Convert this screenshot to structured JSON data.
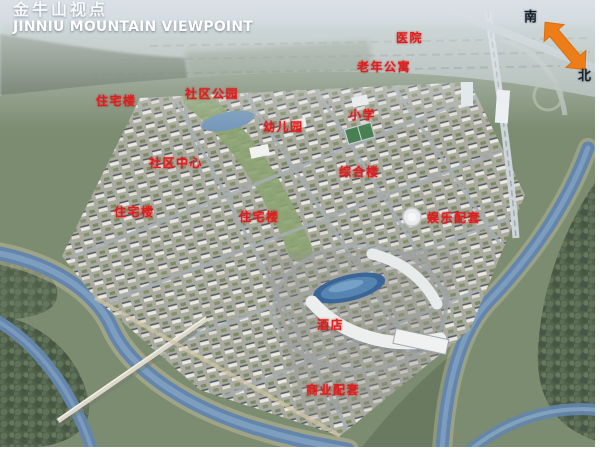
{
  "header": {
    "title_zh": "金牛山视点",
    "title_en": "JINNIU MOUNTAIN VIEWPOINT"
  },
  "compass": {
    "south_label": "南",
    "north_label": "北",
    "arrow_icon": "double-headed-arrow",
    "arrow_color": "#ed7d18"
  },
  "map_labels": [
    {
      "id": "hospital",
      "text": "医院",
      "x": 396,
      "y": 32
    },
    {
      "id": "elderly-apartments",
      "text": "老年公寓",
      "x": 357,
      "y": 61
    },
    {
      "id": "community-park",
      "text": "社区公园",
      "x": 185,
      "y": 88
    },
    {
      "id": "residential-upper-left",
      "text": "住宅楼",
      "x": 96,
      "y": 95
    },
    {
      "id": "primary-school",
      "text": "小学",
      "x": 349,
      "y": 109
    },
    {
      "id": "kindergarten",
      "text": "幼儿园",
      "x": 263,
      "y": 121
    },
    {
      "id": "community-center",
      "text": "社区中心",
      "x": 149,
      "y": 157
    },
    {
      "id": "complex-building",
      "text": "综合楼",
      "x": 339,
      "y": 166
    },
    {
      "id": "residential-lower-left",
      "text": "住宅楼",
      "x": 114,
      "y": 206
    },
    {
      "id": "residential-center",
      "text": "住宅楼",
      "x": 239,
      "y": 211
    },
    {
      "id": "entertainment-facilities",
      "text": "娱乐配套",
      "x": 427,
      "y": 212
    },
    {
      "id": "hotel",
      "text": "酒店",
      "x": 317,
      "y": 319
    },
    {
      "id": "commercial-facilities",
      "text": "商业配套",
      "x": 306,
      "y": 384
    }
  ],
  "colors": {
    "label_red": "#e01d1c",
    "title_white": "#ffffff",
    "water_blue": "#5c80a8",
    "arrow_orange": "#ed7d18"
  }
}
